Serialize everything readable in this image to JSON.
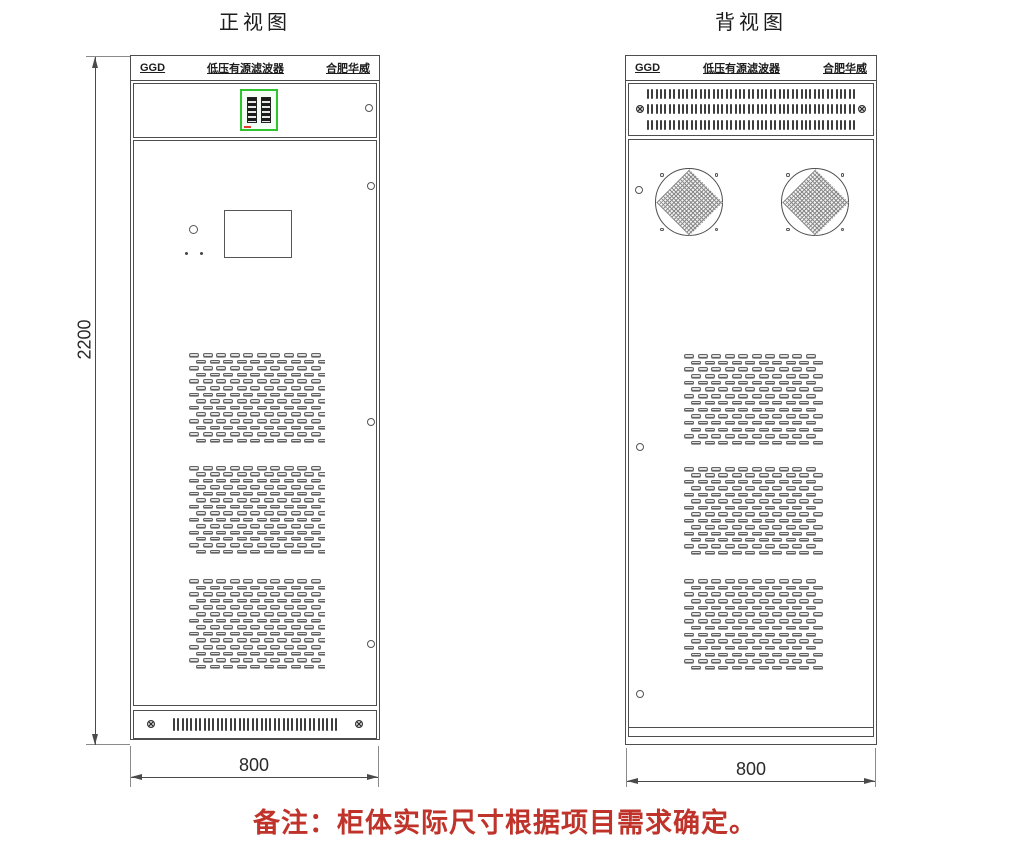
{
  "front_view": {
    "title": "正视图",
    "header": {
      "left": "GGD",
      "center": "低压有源滤波器",
      "right": "合肥华威"
    },
    "width_dim": "800",
    "height_dim": "2200"
  },
  "back_view": {
    "title": "背视图",
    "header": {
      "left": "GGD",
      "center": "低压有源滤波器",
      "right": "合肥华威"
    },
    "width_dim": "800"
  },
  "note": "备注：柜体实际尺寸根据项目需求确定。",
  "colors": {
    "line": "#4d4d4d",
    "note_red": "#bf332b",
    "hmi_green": "#2fc32f"
  },
  "patterns": {
    "louver": {
      "rows": 14,
      "cols": 10
    },
    "base_vent": {
      "rows": 1,
      "cols": 38
    },
    "top_vent": {
      "rows": 3,
      "cols": 48
    }
  }
}
